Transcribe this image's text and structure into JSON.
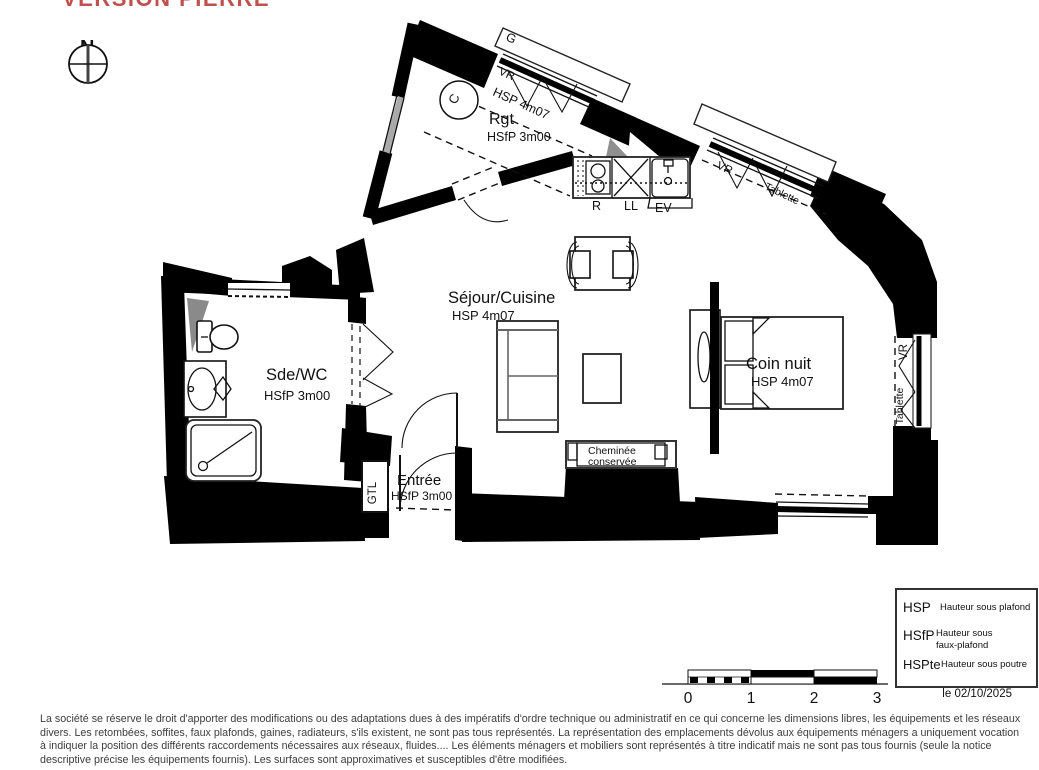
{
  "version_label": "VERSION PIERRE",
  "compass": {
    "north": "N"
  },
  "rooms": {
    "rgt": {
      "name": "Rgt",
      "height": "HSfP 3m00"
    },
    "sejour": {
      "name": "Séjour/Cuisine",
      "height": "HSP 4m07"
    },
    "coin_nuit": {
      "name": "Coin nuit",
      "height": "HSP 4m07"
    },
    "sde_wc": {
      "name": "Sde/WC",
      "height": "HSfP 3m00"
    },
    "entree": {
      "name": "Entrée",
      "height": "HSfP 3m00"
    }
  },
  "annotations": {
    "gaine": "G",
    "volet_roulant": "VR",
    "tablette": "Tablette",
    "sloped_strip_height": "HSP 4m07",
    "chauffe_eau": "C",
    "cuisiniere": "R",
    "lave_linge": "LL",
    "evier": "EV",
    "gtl": "GTL",
    "cheminee_line1": "Cheminée",
    "cheminee_line2": "conservée"
  },
  "legend": {
    "rows": [
      {
        "abbr": "HSP",
        "desc1": "Hauteur sous plafond",
        "desc2": ""
      },
      {
        "abbr": "HSfP",
        "desc1": "Hauteur sous",
        "desc2": "faux-plafond"
      },
      {
        "abbr": "HSPte",
        "desc1": "Hauteur sous poutre",
        "desc2": ""
      }
    ]
  },
  "scale_bar": {
    "labels": [
      "0",
      "1",
      "2",
      "3"
    ]
  },
  "date_label": "le 02/10/2025",
  "disclaimer": "La société se réserve le droit d'apporter des modifications ou des adaptations dues à des impératifs d'ordre technique ou administratif en ce qui concerne les dimensions libres, les équipements et les réseaux divers. Les retombées, soffites, faux plafonds, gaines, radiateurs, s'ils existent, ne sont pas tous représentés. La représentation des emplacements dévolus aux équipements ménagers a uniquement vocation à indiquer la position des différents raccordements nécessaires aux réseaux, fluides.... Les éléments ménagers et mobiliers sont représentés à titre indicatif mais ne sont pas tous fournis (seule la notice descriptive précise les équipements fournis). Les surfaces sont approximatives et susceptibles d'être modifiées."
}
